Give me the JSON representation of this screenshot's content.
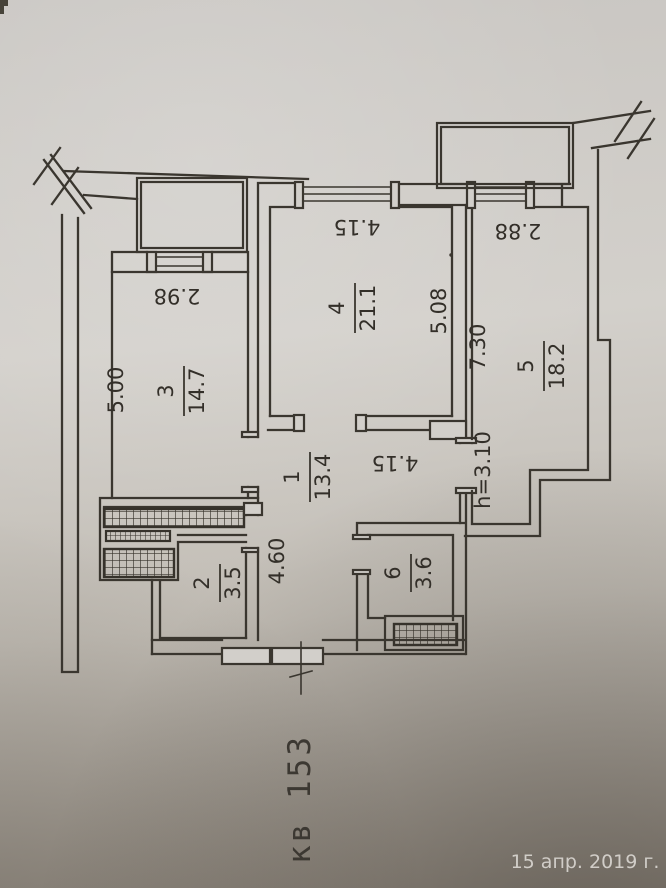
{
  "photo_overlay": {
    "date": "15 апр. 2019 г."
  },
  "plan": {
    "apartment_label": "кв 153",
    "rooms": [
      {
        "number": "1",
        "area": "13.4"
      },
      {
        "number": "2",
        "area": "3.5"
      },
      {
        "number": "3",
        "area": "14.7"
      },
      {
        "number": "4",
        "area": "21.1"
      },
      {
        "number": "5",
        "area": "18.2"
      },
      {
        "number": "6",
        "area": "3.6"
      }
    ],
    "dimensions": {
      "room3_window_width": "2.98",
      "room3_length": "5.00",
      "room4_width": "4.15",
      "room4_length": "5.08",
      "room5_length": "7.30",
      "room5_balcony_width": "2.88",
      "hall_width": "4.15",
      "corridor_length": "4.60",
      "ceiling_height": "h=3.10"
    }
  },
  "colors": {
    "ink": "#3a362f",
    "paper_light": "#d3d0cb",
    "paper_dark": "#948c82",
    "date_text": "#d9d6d1"
  }
}
